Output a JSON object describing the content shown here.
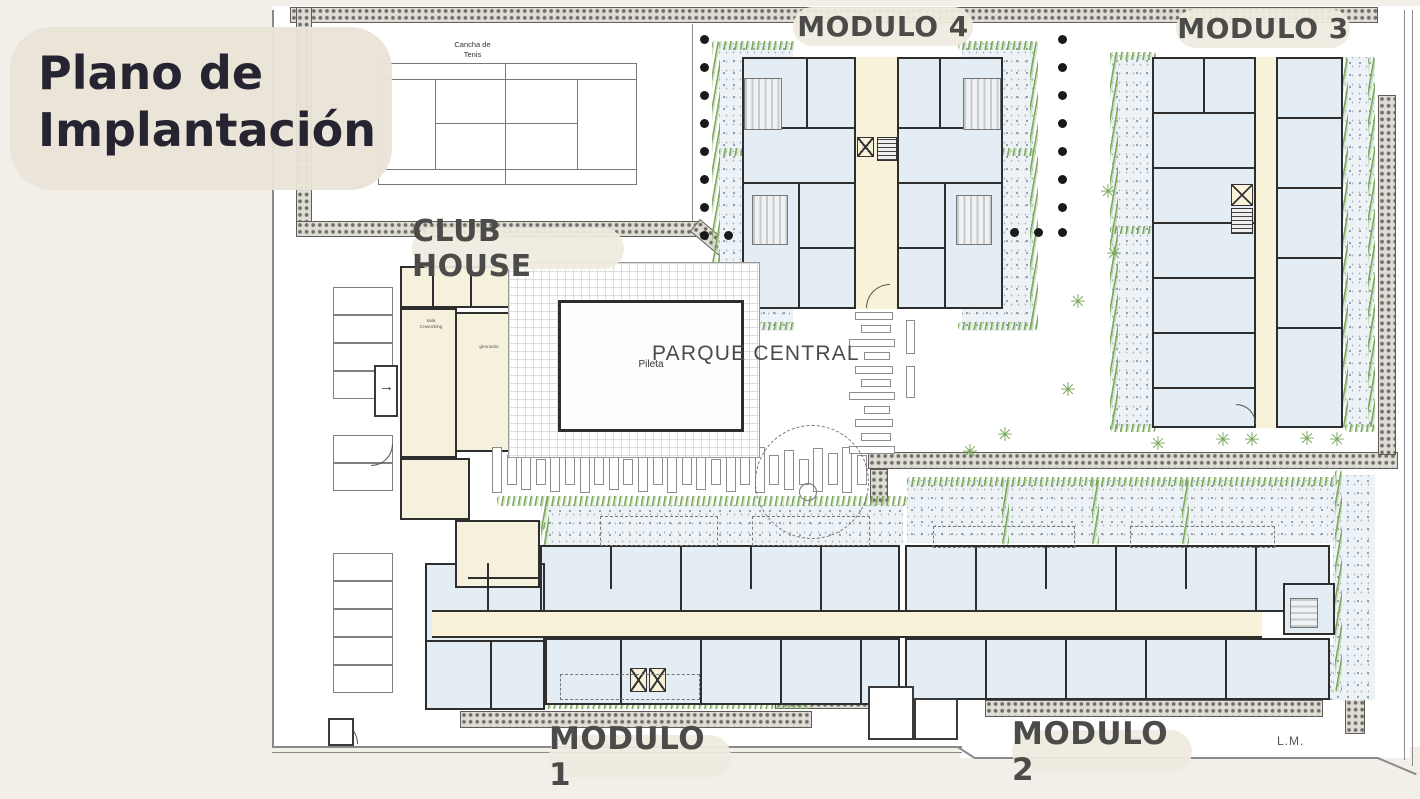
{
  "title": {
    "line1": "Plano de",
    "line2": "Implantación"
  },
  "labels": {
    "modulo4": "MODULO 4",
    "modulo3": "MODULO 3",
    "modulo1": "MODULO 1",
    "modulo2": "MODULO 2",
    "club_house": "CLUB HOUSE",
    "parque_central": "PARQUE CENTRAL",
    "tennis_line1": "Cancha de",
    "tennis_line2": "Tenis",
    "pool": "Pileta",
    "boundary": "L.M.",
    "room_coworking_line1": "sala",
    "room_coworking_line2": "Coworking",
    "room_gym": "gimnasio"
  },
  "icons": {
    "shrub": "✳",
    "entry_arrow": "→",
    "tree_dot": "●"
  },
  "colors": {
    "page_bg": "#f2efe9",
    "plan_bg": "#ffffff",
    "pill_bg": "#f0ebdf",
    "title_text": "#262431",
    "label_text": "#4b4b49",
    "wall": "#2e2e2e",
    "room_fill": "#e5edf4",
    "corridor_fill": "#f7f2d8",
    "clubhouse_fill": "#f6f1dc",
    "garden_fill": "#edf2f7",
    "hedge_green": "#7fae5e",
    "line": "#8a8a8a"
  }
}
